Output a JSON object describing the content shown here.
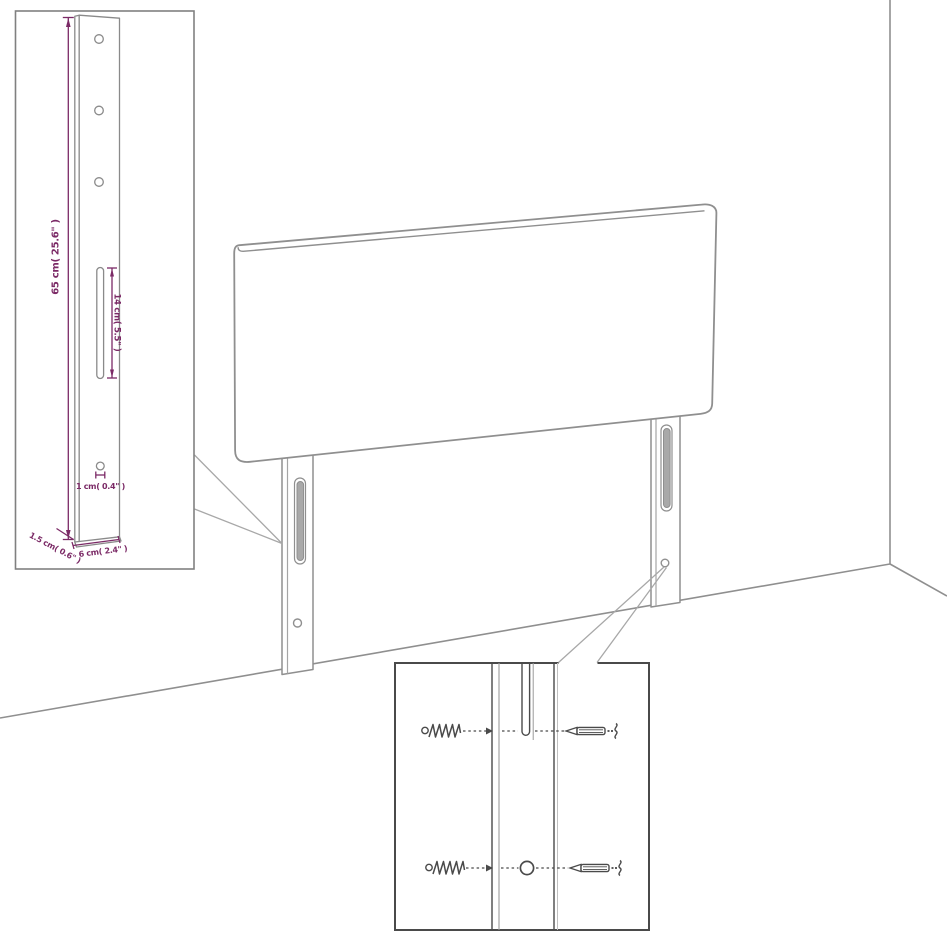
{
  "canvas": {
    "width": 947,
    "height": 947,
    "background": "#ffffff"
  },
  "palette": {
    "dimension_color": "#7b2a66",
    "outline_color": "#8f8f8f",
    "hardware_color": "#4a4a4a"
  },
  "leg_detail_inset": {
    "height_label": "65 cm( 25.6\" )",
    "slot_label": "14 cm( 5.5\" )",
    "hole_label": "1 cm( 0.4\" )",
    "thickness_label": "1.5 cm( 0.6\" )",
    "width_label": "6 cm( 2.4\" )"
  },
  "hardware_inset": {
    "icons": [
      "wood-screw-icon",
      "wall-plug-screw-icon",
      "wood-screw-icon",
      "wall-plug-screw-icon",
      "mounting-slot",
      "mounting-hole"
    ]
  }
}
